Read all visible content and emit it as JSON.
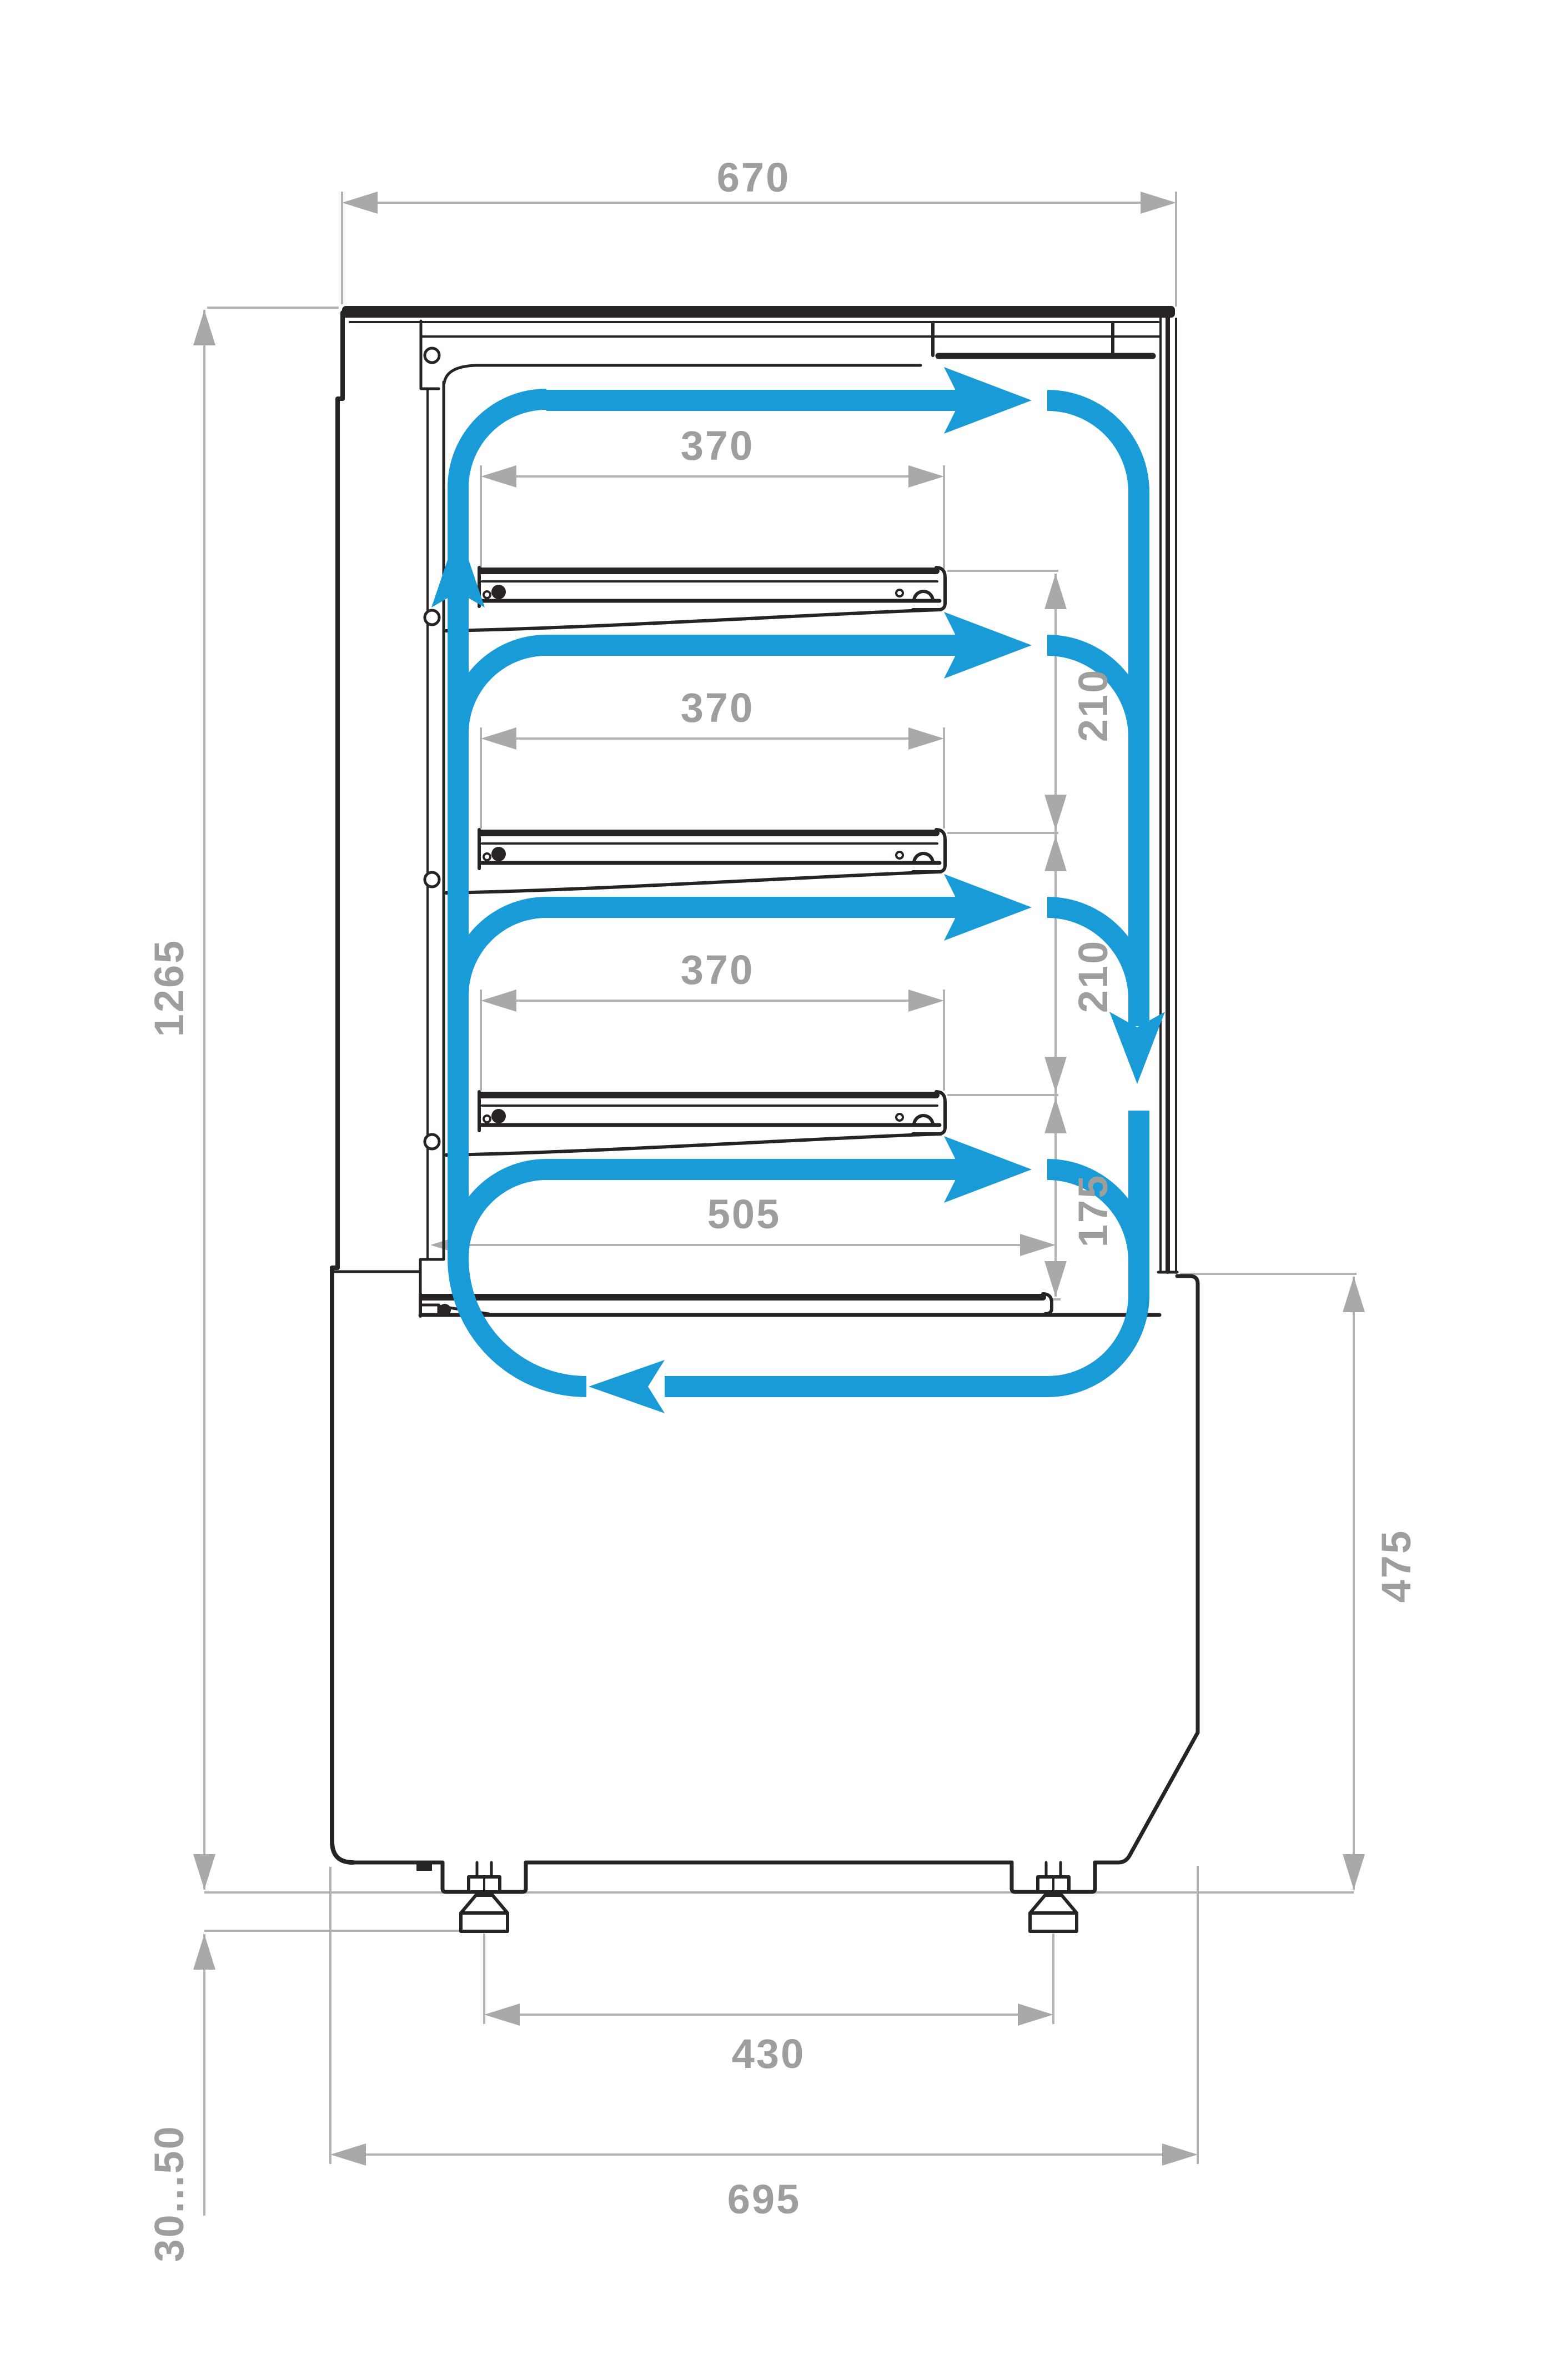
{
  "page": {
    "kind": "technical dimension drawing",
    "subject": "Refrigerated pastry display case - side cross-section with air circulation",
    "background": "#ffffff"
  },
  "colors": {
    "outline": "#272324",
    "dimension_lines": "#b3b3b2",
    "dimension_text": "#9e9e9d",
    "airflow_accent": "#199bd8"
  },
  "dimensions_mm": {
    "top_width": "670",
    "shelf_1_depth": "370",
    "shelf_2_depth": "370",
    "shelf_3_depth": "370",
    "shelf_gap_1": "210",
    "shelf_gap_2": "210",
    "base_deck_depth": "505",
    "base_deck_gap": "175",
    "overall_height": "1265",
    "base_section_height": "475",
    "feet_spacing": "430",
    "base_width": "695",
    "feet_adjustment_range": "30...50"
  },
  "airflow": {
    "direction": "clockwise loop: up the rear duct, across each shelf gap, down the front glass, back along the base",
    "icons": [
      "airflow-up-arrow-icon",
      "airflow-right-arrow-icon",
      "airflow-down-arrow-icon",
      "airflow-left-arrow-icon"
    ]
  }
}
